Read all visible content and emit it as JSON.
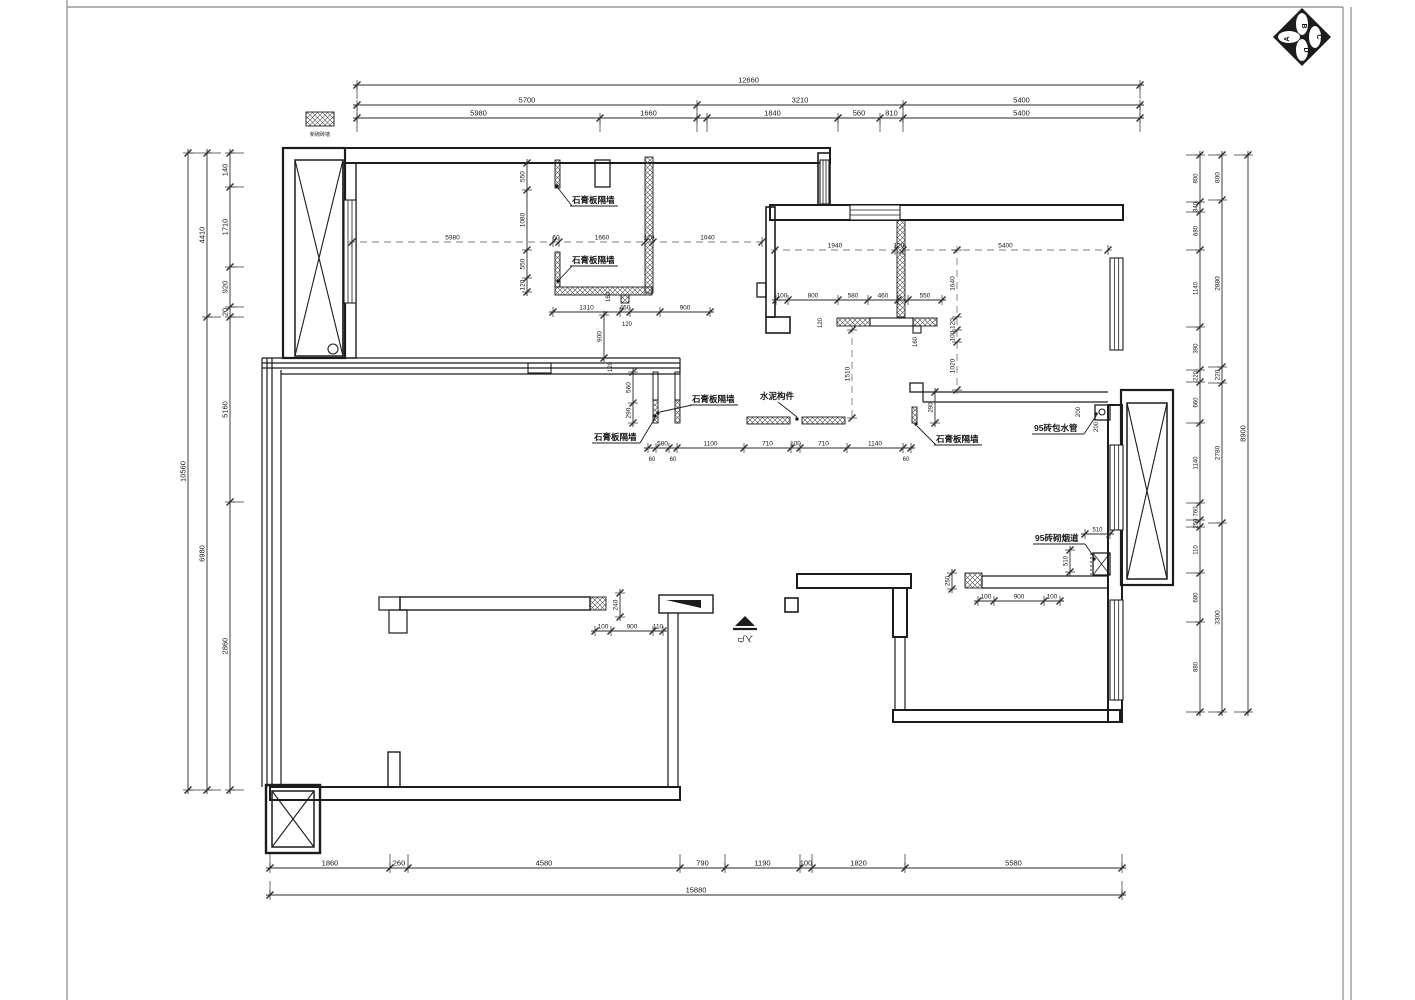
{
  "meta": {
    "ink": "#1c1c1c",
    "dim_ink": "#2a2a2a",
    "dash_ink": "#7e7e7e",
    "frame_ink": "#9a9a9a",
    "bg": "#ffffff"
  },
  "legend": {
    "swatch": [
      306,
      112,
      28,
      14
    ],
    "label": "新砌砖墙",
    "label_pos": [
      320,
      136
    ]
  },
  "compass": {
    "cx": 1302,
    "cy": 37,
    "r": 29,
    "letters": [
      "A",
      "B",
      "C",
      "D"
    ]
  },
  "entry": {
    "text": "入户",
    "pos": [
      745,
      636
    ],
    "arrow": [
      [
        735,
        626
      ],
      [
        755,
        626
      ],
      [
        745,
        616
      ]
    ],
    "bar": [
      733,
      629,
      757,
      629
    ]
  },
  "frame": [
    [
      67,
      0,
      67,
      1000
    ],
    [
      67,
      7,
      1343,
      7
    ],
    [
      1343,
      7,
      1343,
      1000
    ],
    [
      1351,
      7,
      1351,
      1000
    ]
  ],
  "walls": {
    "rects": [
      [
        345,
        148,
        485,
        15,
        2
      ],
      [
        283,
        148,
        62,
        210,
        2.2
      ],
      [
        343,
        163,
        13,
        195,
        1.4
      ],
      [
        270,
        787,
        410,
        13,
        2
      ],
      [
        388,
        752,
        12,
        35,
        1.4
      ],
      [
        266,
        785,
        54,
        68,
        2.4
      ],
      [
        659,
        595,
        54,
        18,
        1.4
      ],
      [
        400,
        597,
        190,
        13,
        1.4
      ],
      [
        379,
        597,
        21,
        13,
        1.2
      ],
      [
        389,
        610,
        18,
        23,
        1.2
      ],
      [
        797,
        574,
        114,
        14,
        2
      ],
      [
        785,
        598,
        13,
        14,
        1.6
      ],
      [
        893,
        588,
        14,
        49,
        2
      ],
      [
        893,
        710,
        227,
        12,
        2
      ],
      [
        1108,
        405,
        14,
        317,
        2
      ],
      [
        770,
        205,
        353,
        15,
        2
      ],
      [
        818,
        153,
        12,
        52,
        1.6
      ],
      [
        1095,
        405,
        15,
        15,
        1.3
      ],
      [
        1121,
        390,
        52,
        195,
        2.2
      ],
      [
        1093,
        553,
        17,
        22,
        1.3
      ],
      [
        595,
        160,
        15,
        27,
        1.3
      ],
      [
        766,
        207,
        9,
        110,
        1.6
      ],
      [
        757,
        283,
        9,
        14,
        1.3
      ],
      [
        766,
        317,
        24,
        16,
        1.6
      ],
      [
        910,
        383,
        13,
        9,
        1.3
      ],
      [
        528,
        363,
        23,
        10,
        1.1
      ],
      [
        870,
        318,
        43,
        8,
        1.1
      ],
      [
        913,
        326,
        8,
        7,
        1.1
      ],
      [
        653,
        372,
        5,
        28,
        1
      ],
      [
        675,
        372,
        5,
        28,
        1
      ]
    ],
    "lines": [
      [
        262,
        358,
        262,
        787
      ],
      [
        267,
        358,
        267,
        787
      ],
      [
        272,
        358,
        272,
        787
      ],
      [
        281,
        370,
        281,
        787
      ],
      [
        262,
        358,
        680,
        358
      ],
      [
        262,
        363,
        680,
        363
      ],
      [
        262,
        368,
        680,
        368
      ],
      [
        281,
        374,
        680,
        374
      ],
      [
        680,
        358,
        680,
        374
      ],
      [
        668,
        613,
        668,
        787
      ],
      [
        678,
        613,
        678,
        787
      ],
      [
        895,
        637,
        895,
        710
      ],
      [
        905,
        637,
        905,
        710
      ],
      [
        923,
        392,
        1108,
        392
      ],
      [
        923,
        402,
        1108,
        402
      ],
      [
        923,
        392,
        923,
        402
      ],
      [
        982,
        576,
        1108,
        576
      ],
      [
        982,
        588,
        1108,
        588
      ],
      [
        982,
        576,
        982,
        588
      ],
      [
        1093,
        553,
        1110,
        575,
        0.8
      ],
      [
        1110,
        553,
        1093,
        575,
        0.8
      ]
    ]
  },
  "hatch": [
    [
      645,
      157,
      8,
      136
    ],
    [
      555,
      287,
      97,
      8
    ],
    [
      621,
      295,
      8,
      8
    ],
    [
      555,
      160,
      5,
      28
    ],
    [
      555,
      252,
      5,
      35
    ],
    [
      897,
      220,
      8,
      97
    ],
    [
      837,
      318,
      33,
      8
    ],
    [
      913,
      318,
      24,
      8
    ],
    [
      747,
      417,
      43,
      7
    ],
    [
      802,
      417,
      43,
      7
    ],
    [
      653,
      400,
      5,
      23
    ],
    [
      675,
      400,
      5,
      23
    ],
    [
      912,
      407,
      5,
      16
    ],
    [
      965,
      573,
      17,
      15
    ],
    [
      590,
      597,
      16,
      13
    ],
    [
      306,
      112,
      28,
      14
    ]
  ],
  "windows": [
    [
      344,
      200,
      12,
      103,
      "v"
    ],
    [
      820,
      160,
      9,
      44,
      "v"
    ],
    [
      850,
      205,
      50,
      15,
      "h"
    ],
    [
      1110,
      258,
      13,
      92,
      "v"
    ],
    [
      1110,
      445,
      13,
      85,
      "v"
    ],
    [
      1110,
      600,
      13,
      100,
      "v"
    ]
  ],
  "xboxes": [
    [
      295,
      160,
      48,
      196
    ],
    [
      272,
      791,
      42,
      56
    ],
    [
      1127,
      403,
      40,
      176
    ]
  ],
  "circles": [
    [
      333,
      349,
      5
    ],
    [
      1102,
      412,
      3
    ]
  ],
  "solids": [
    [
      [
        666,
        600
      ],
      [
        701,
        600
      ],
      [
        701,
        608
      ]
    ]
  ],
  "dashlines": [
    [
      1091,
      553,
      1091,
      575
    ]
  ],
  "chains": [
    {
      "o": "h",
      "p": 85,
      "t": [
        357,
        1140
      ],
      "l": [
        "12660"
      ],
      "e": 1
    },
    {
      "o": "h",
      "p": 105,
      "t": [
        357,
        697,
        903,
        1140
      ],
      "l": [
        "5700",
        "3210",
        "5400"
      ],
      "e": 1
    },
    {
      "o": "h",
      "p": 118,
      "t": [
        357,
        600,
        697,
        707,
        838,
        880,
        903,
        1140
      ],
      "l": [
        "5980",
        "1660",
        "",
        "1840",
        "560",
        "810",
        "5400"
      ],
      "e": 1
    },
    {
      "o": "h",
      "p": 868,
      "t": [
        270,
        390,
        408,
        680,
        725,
        800,
        812,
        905,
        1122
      ],
      "l": [
        "1860",
        "260",
        "4580",
        "790",
        "1190",
        "100",
        "1820",
        "5580"
      ],
      "e": -1
    },
    {
      "o": "h",
      "p": 895,
      "t": [
        270,
        1122
      ],
      "l": [
        "15880"
      ],
      "e": -1
    },
    {
      "o": "h",
      "p": 312,
      "t": [
        553,
        620,
        630,
        660,
        710
      ],
      "l": [
        "1310",
        "460",
        "",
        "900"
      ],
      "fs": 6.5
    },
    {
      "o": "h",
      "p": 448,
      "t": [
        648,
        656,
        669,
        677,
        744,
        791,
        800,
        847,
        903,
        911
      ],
      "l": [
        "",
        "580",
        "",
        "1100",
        "710",
        "100",
        "710",
        "1140",
        ""
      ],
      "fs": 6.5
    },
    {
      "o": "h",
      "p": 300,
      "t": [
        776,
        788,
        838,
        868,
        898,
        908,
        942
      ],
      "l": [
        "100",
        "800",
        "580",
        "460",
        "",
        "550"
      ],
      "fs": 6.5
    },
    {
      "o": "h",
      "p": 631,
      "t": [
        595,
        611,
        653,
        663
      ],
      "l": [
        "100",
        "900",
        "110"
      ],
      "fs": 6.5
    },
    {
      "o": "h",
      "p": 601,
      "t": [
        978,
        994,
        1044,
        1060
      ],
      "l": [
        "100",
        "900",
        "100"
      ],
      "fs": 6.5
    },
    {
      "o": "h",
      "p": 534,
      "t": [
        1085,
        1110
      ],
      "l": [
        "510"
      ],
      "fs": 6
    },
    {
      "o": "h",
      "p": 242,
      "t": [
        352,
        553,
        559,
        645,
        653,
        762
      ],
      "l": [
        "5980",
        "60",
        "1660",
        "120",
        "1040"
      ],
      "fs": 6.5,
      "dash": 1
    },
    {
      "o": "h",
      "p": 250,
      "t": [
        775,
        895,
        903,
        1108
      ],
      "l": [
        "1940",
        "120",
        "5400"
      ],
      "fs": 6.5,
      "dash": 1
    },
    {
      "o": "v",
      "p": 188,
      "t": [
        153,
        790
      ],
      "l": [
        "10560"
      ],
      "e": 1
    },
    {
      "o": "v",
      "p": 207,
      "t": [
        153,
        317,
        790
      ],
      "l": [
        "4410",
        "6980"
      ],
      "e": 1
    },
    {
      "o": "v",
      "p": 230,
      "t": [
        153,
        187,
        267,
        307,
        317,
        502,
        790
      ],
      "l": [
        "140",
        "1710",
        "920",
        "20",
        "5160",
        "2860"
      ],
      "e": 1
    },
    {
      "o": "v",
      "p": 1200,
      "t": [
        155,
        202,
        212,
        250,
        327,
        370,
        382,
        423,
        503,
        520,
        527,
        573,
        622,
        712
      ],
      "l": [
        "800",
        "340",
        "680",
        "1140",
        "390",
        "220",
        "660",
        "1140",
        "760",
        "250",
        "110",
        "680",
        "880"
      ],
      "fs": 6,
      "e": -1
    },
    {
      "o": "v",
      "p": 1222,
      "t": [
        155,
        200,
        367,
        383,
        523,
        712
      ],
      "l": [
        "800",
        "2880",
        "220",
        "2780",
        "3300"
      ],
      "fs": 6.5,
      "e": -1
    },
    {
      "o": "v",
      "p": 1248,
      "t": [
        155,
        712
      ],
      "l": [
        "8900"
      ],
      "e": -1
    },
    {
      "o": "v",
      "p": 527,
      "t": [
        163,
        190,
        250,
        278,
        292
      ],
      "l": [
        "550",
        "1080",
        "550",
        "120"
      ],
      "fs": 6.5
    },
    {
      "o": "v",
      "p": 633,
      "t": [
        372,
        403,
        423
      ],
      "l": [
        "560",
        "290"
      ],
      "fs": 6.5
    },
    {
      "o": "v",
      "p": 620,
      "t": [
        593,
        617
      ],
      "l": [
        "240"
      ],
      "fs": 6.5
    },
    {
      "o": "v",
      "p": 952,
      "t": [
        573,
        589
      ],
      "l": [
        "250"
      ],
      "fs": 6
    },
    {
      "o": "v",
      "p": 935,
      "t": [
        392,
        423
      ],
      "l": [
        "290"
      ],
      "fs": 6
    },
    {
      "o": "v",
      "p": 604,
      "t": [
        315,
        358
      ],
      "l": [
        "900"
      ],
      "fs": 6.5
    },
    {
      "o": "v",
      "p": 1070,
      "t": [
        550,
        572
      ],
      "l": [
        "510"
      ],
      "fs": 6
    },
    {
      "o": "v",
      "p": 957,
      "t": [
        250,
        317,
        330,
        342,
        390
      ],
      "l": [
        "1640",
        "120",
        "100",
        "1020"
      ],
      "fs": 6.5,
      "dash": 1
    },
    {
      "o": "v",
      "p": 852,
      "t": [
        330,
        418
      ],
      "l": [
        "1510"
      ],
      "fs": 6.5,
      "dash": 1
    }
  ],
  "texts": [
    {
      "x": 652,
      "y": 461,
      "s": "60",
      "fs": 6
    },
    {
      "x": 673,
      "y": 461,
      "s": "60",
      "fs": 6
    },
    {
      "x": 906,
      "y": 461,
      "s": "60",
      "fs": 6
    },
    {
      "x": 627,
      "y": 326,
      "s": "120",
      "fs": 6
    },
    {
      "x": 610,
      "y": 297,
      "s": "160",
      "fs": 6,
      "rot": -90
    },
    {
      "x": 822,
      "y": 323,
      "s": "120",
      "fs": 6,
      "rot": -90
    },
    {
      "x": 917,
      "y": 342,
      "s": "160",
      "fs": 6,
      "rot": -90
    },
    {
      "x": 1080,
      "y": 412,
      "s": "200",
      "fs": 6,
      "rot": -90
    },
    {
      "x": 1098,
      "y": 427,
      "s": "200",
      "fs": 6,
      "rot": -90
    },
    {
      "x": 612,
      "y": 367,
      "s": "120",
      "fs": 6,
      "rot": -90
    }
  ],
  "leaders": [
    {
      "s": "石膏板隔墙",
      "tx": 572,
      "ty": 203,
      "u": 46,
      "pts": [
        [
          572,
          206
        ],
        [
          558,
          188
        ]
      ],
      "dot": [
        557,
        186
      ]
    },
    {
      "s": "石膏板隔墙",
      "tx": 572,
      "ty": 263,
      "u": 46,
      "pts": [
        [
          572,
          266
        ],
        [
          559,
          280
        ]
      ],
      "dot": [
        558,
        281
      ]
    },
    {
      "s": "石膏板隔墙",
      "tx": 692,
      "ty": 402,
      "u": 46,
      "pts": [
        [
          692,
          405
        ],
        [
          660,
          412
        ]
      ],
      "dot": [
        658,
        413
      ]
    },
    {
      "s": "石膏板隔墙",
      "tx": 594,
      "ty": 440,
      "u": 46,
      "pts": [
        [
          640,
          443
        ],
        [
          655,
          418
        ]
      ],
      "dot": [
        655,
        416
      ]
    },
    {
      "s": "水泥构件",
      "tx": 760,
      "ty": 399,
      "u": 0,
      "pts": [
        [
          778,
          402
        ],
        [
          797,
          417
        ]
      ],
      "dot": [
        797,
        419
      ]
    },
    {
      "s": "石膏板隔墙",
      "tx": 936,
      "ty": 442,
      "u": 46,
      "pts": [
        [
          936,
          445
        ],
        [
          917,
          426
        ]
      ],
      "dot": [
        916,
        424
      ]
    },
    {
      "s": "95砖包水管",
      "tx": 1034,
      "ty": 431,
      "u": 50,
      "pts": [
        [
          1084,
          434
        ],
        [
          1096,
          416
        ]
      ],
      "dot": [
        1096,
        414
      ]
    },
    {
      "s": "95砖砌烟道",
      "tx": 1035,
      "ty": 541,
      "u": 50,
      "pts": [
        [
          1085,
          544
        ],
        [
          1094,
          557
        ]
      ],
      "dot": [
        1094,
        559
      ]
    }
  ]
}
